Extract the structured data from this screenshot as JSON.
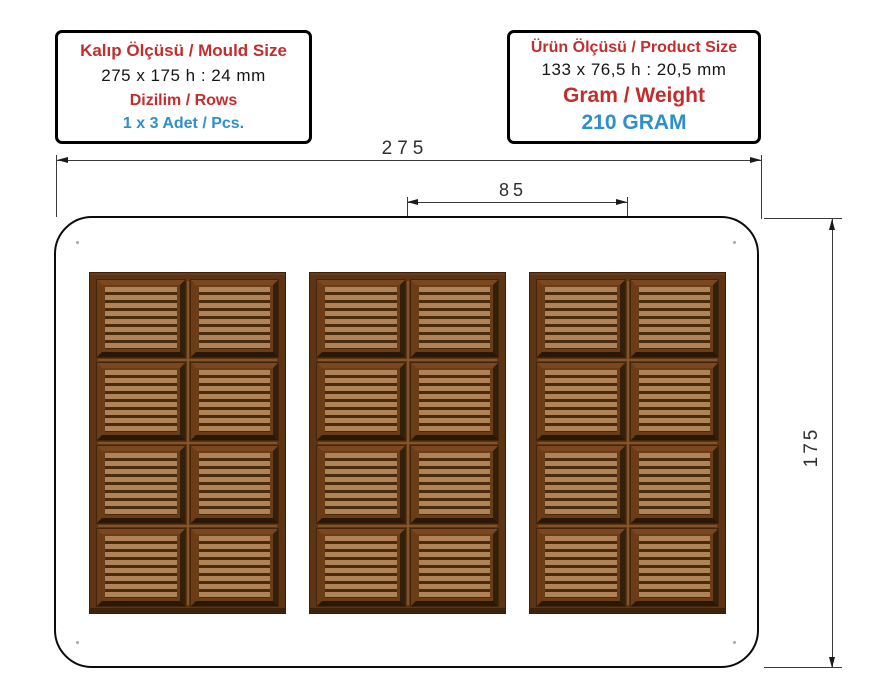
{
  "info_boxes": {
    "mould": {
      "title": "Kalıp Ölçüsü / Mould Size",
      "size": "275 x 175 h : 24 mm",
      "rows_label": "Dizilim / Rows",
      "rows_value": "1 x 3 Adet / Pcs."
    },
    "product": {
      "title": "Ürün Ölçüsü / Product Size",
      "size": "133 x 76,5 h : 20,5 mm",
      "weight_label": "Gram / Weight",
      "weight_value": "210 GRAM"
    }
  },
  "dimensions": {
    "mould_width_mm": "275",
    "bar_pitch_mm": "85",
    "mould_height_mm": "175"
  },
  "drawing": {
    "bar_count": 3,
    "segment_rows": 4,
    "segment_cols": 2
  },
  "colors": {
    "label_red": "#C22E2E",
    "value_blue": "#2E8FCB",
    "dimension_line": "#3A3A3A",
    "chocolate_frame": "#5E3413",
    "chocolate_stripe_light": "#B08258",
    "chocolate_stripe_dark": "#4A2A0C"
  }
}
